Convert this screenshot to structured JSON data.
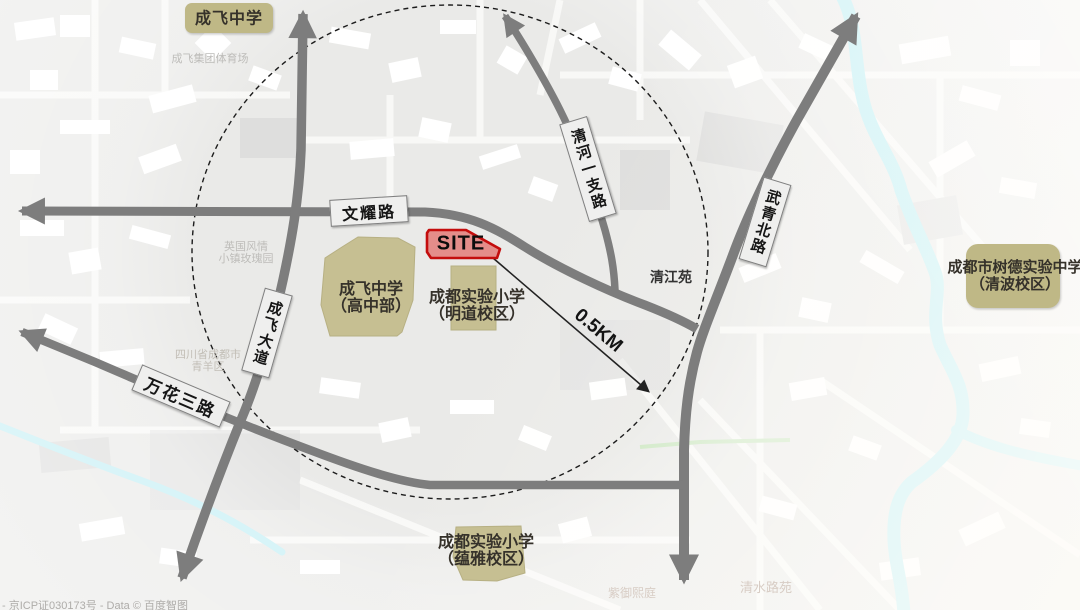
{
  "site": {
    "label": "SITE"
  },
  "distance": {
    "label": "0.5KM"
  },
  "roads": [
    {
      "id": "wenyao-road",
      "label": "文耀路"
    },
    {
      "id": "wanhua-3rd-road",
      "label": "万花三路"
    },
    {
      "id": "chengfei-avenue",
      "label": "成飞大道"
    },
    {
      "id": "qinghe-branch-road",
      "label": "清河一支路"
    },
    {
      "id": "wuqing-north-road",
      "label": "武青北路"
    }
  ],
  "schools": [
    {
      "id": "chengfei-middle-school",
      "label": "成飞中学"
    },
    {
      "id": "chengfei-high-campus",
      "line1": "成飞中学",
      "line2": "（高中部）"
    },
    {
      "id": "mingdao-campus",
      "line1": "成都实验小学",
      "line2": "（明道校区）"
    },
    {
      "id": "yunya-campus",
      "line1": "成都实验小学",
      "line2": "（蕴雅校区）"
    },
    {
      "id": "shude-qingbo-campus",
      "line1": "成都市树德实验中学",
      "line2": "（清波校区）"
    }
  ],
  "places": {
    "qingjiangyuan": "清江苑"
  },
  "basemap": {
    "labels": [
      {
        "id": "stadium",
        "text": "成飞集团体育场"
      },
      {
        "id": "rose-town",
        "line1": "英国风情",
        "line2": "小镇玫瑰园"
      },
      {
        "id": "qingyang-district",
        "line1": "四川省成都市",
        "line2": "青羊区"
      },
      {
        "id": "qingshui-court",
        "text": "清水路苑"
      },
      {
        "id": "ziyu-court",
        "text": "紫御熙庭"
      }
    ],
    "attribution": "- 京ICP证030173号 - Data © 百度智图"
  },
  "colors": {
    "road": "#7d7d7d",
    "tan_parcel": "#c6bf92",
    "tan_box": "#bfb886",
    "river": "#b3ecf2",
    "site_fill": "#e2807c",
    "site_border": "#c40d0d"
  }
}
